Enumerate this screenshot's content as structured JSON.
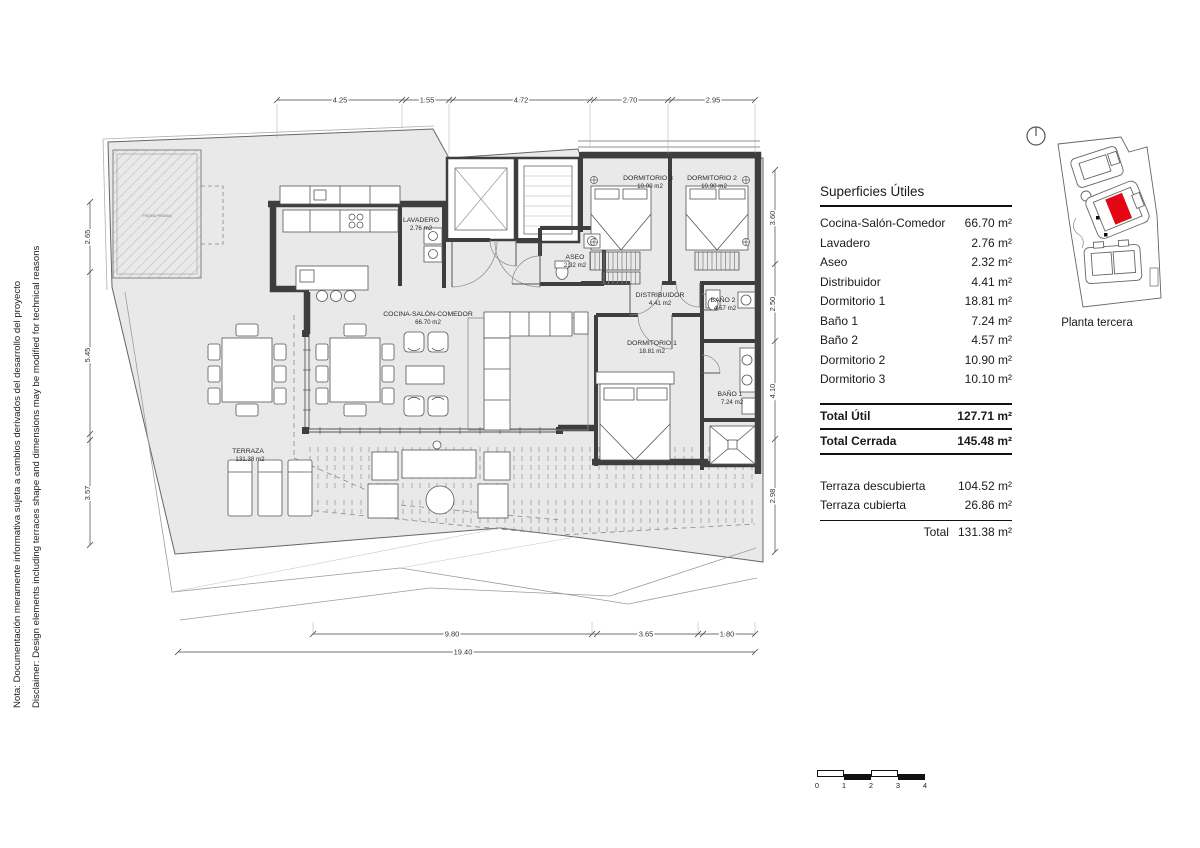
{
  "notes": {
    "nota": "Nota: Documentación meramente informativa sujeta a cambios derivados del desarrollo del proyecto",
    "disclaimer": "Disclaimer: Design elements including terraces shape and dimensions may be modified for technical reasons"
  },
  "plan": {
    "rooms": {
      "cocina": {
        "name": "COCINA-SALÓN-COMEDOR",
        "area": "66.70 m2"
      },
      "lavadero": {
        "name": "LAVADERO",
        "area": "2.76 m2"
      },
      "aseo": {
        "name": "ASEO",
        "area": "2.32 m2"
      },
      "distribuidor": {
        "name": "DISTRIBUIDOR",
        "area": "4.41 m2"
      },
      "dormitorio1": {
        "name": "DORMITORIO 1",
        "area": "18.81 m2"
      },
      "dormitorio2": {
        "name": "DORMITORIO 2",
        "area": "10.90 m2"
      },
      "dormitorio3": {
        "name": "DORMITORIO 3",
        "area": "10.00 m2"
      },
      "bano1": {
        "name": "BAÑO 1",
        "area": "7.24 m2"
      },
      "bano2": {
        "name": "BAÑO 2",
        "area": "4.57 m2"
      },
      "terraza": {
        "name": "TERRAZA",
        "area": "131.38 m2"
      },
      "pergola": {
        "name": "PISCINA PRIVADA"
      }
    },
    "dims": {
      "top": [
        "4.25",
        "1.55",
        "4.72",
        "2.70",
        "2.95"
      ],
      "left": [
        "2.65",
        "5.45",
        "3.57"
      ],
      "right": [
        "3.60",
        "2.50",
        "4.10",
        "2.98"
      ],
      "bottom": [
        "9.80",
        "3.65",
        "1.80"
      ],
      "total": "19.40"
    }
  },
  "table": {
    "title": "Superficies Útiles",
    "rows": [
      {
        "label": "Cocina-Salón-Comedor",
        "value": "66.70 m²"
      },
      {
        "label": "Lavadero",
        "value": "2.76 m²"
      },
      {
        "label": "Aseo",
        "value": "2.32 m²"
      },
      {
        "label": "Distribuidor",
        "value": "4.41 m²"
      },
      {
        "label": "Dormitorio 1",
        "value": "18.81 m²"
      },
      {
        "label": "Baño 1",
        "value": "7.24 m²"
      },
      {
        "label": "Baño 2",
        "value": "4.57 m²"
      },
      {
        "label": "Dormitorio 2",
        "value": "10.90 m²"
      },
      {
        "label": "Dormitorio 3",
        "value": "10.10 m²"
      }
    ],
    "total_util": {
      "label": "Total Útil",
      "value": "127.71 m²"
    },
    "total_cerrada": {
      "label": "Total Cerrada",
      "value": "145.48 m²"
    },
    "terrace_rows": [
      {
        "label": "Terraza descubierta",
        "value": "104.52 m²"
      },
      {
        "label": "Terraza cubierta",
        "value": "26.86 m²"
      }
    ],
    "terrace_total": {
      "label": "Total",
      "value": "131.38 m²"
    }
  },
  "siteplan": {
    "caption": "Planta tercera",
    "highlight_color": "#e30613"
  },
  "scalebar": {
    "labels": [
      "0",
      "1",
      "2",
      "3",
      "4"
    ]
  }
}
